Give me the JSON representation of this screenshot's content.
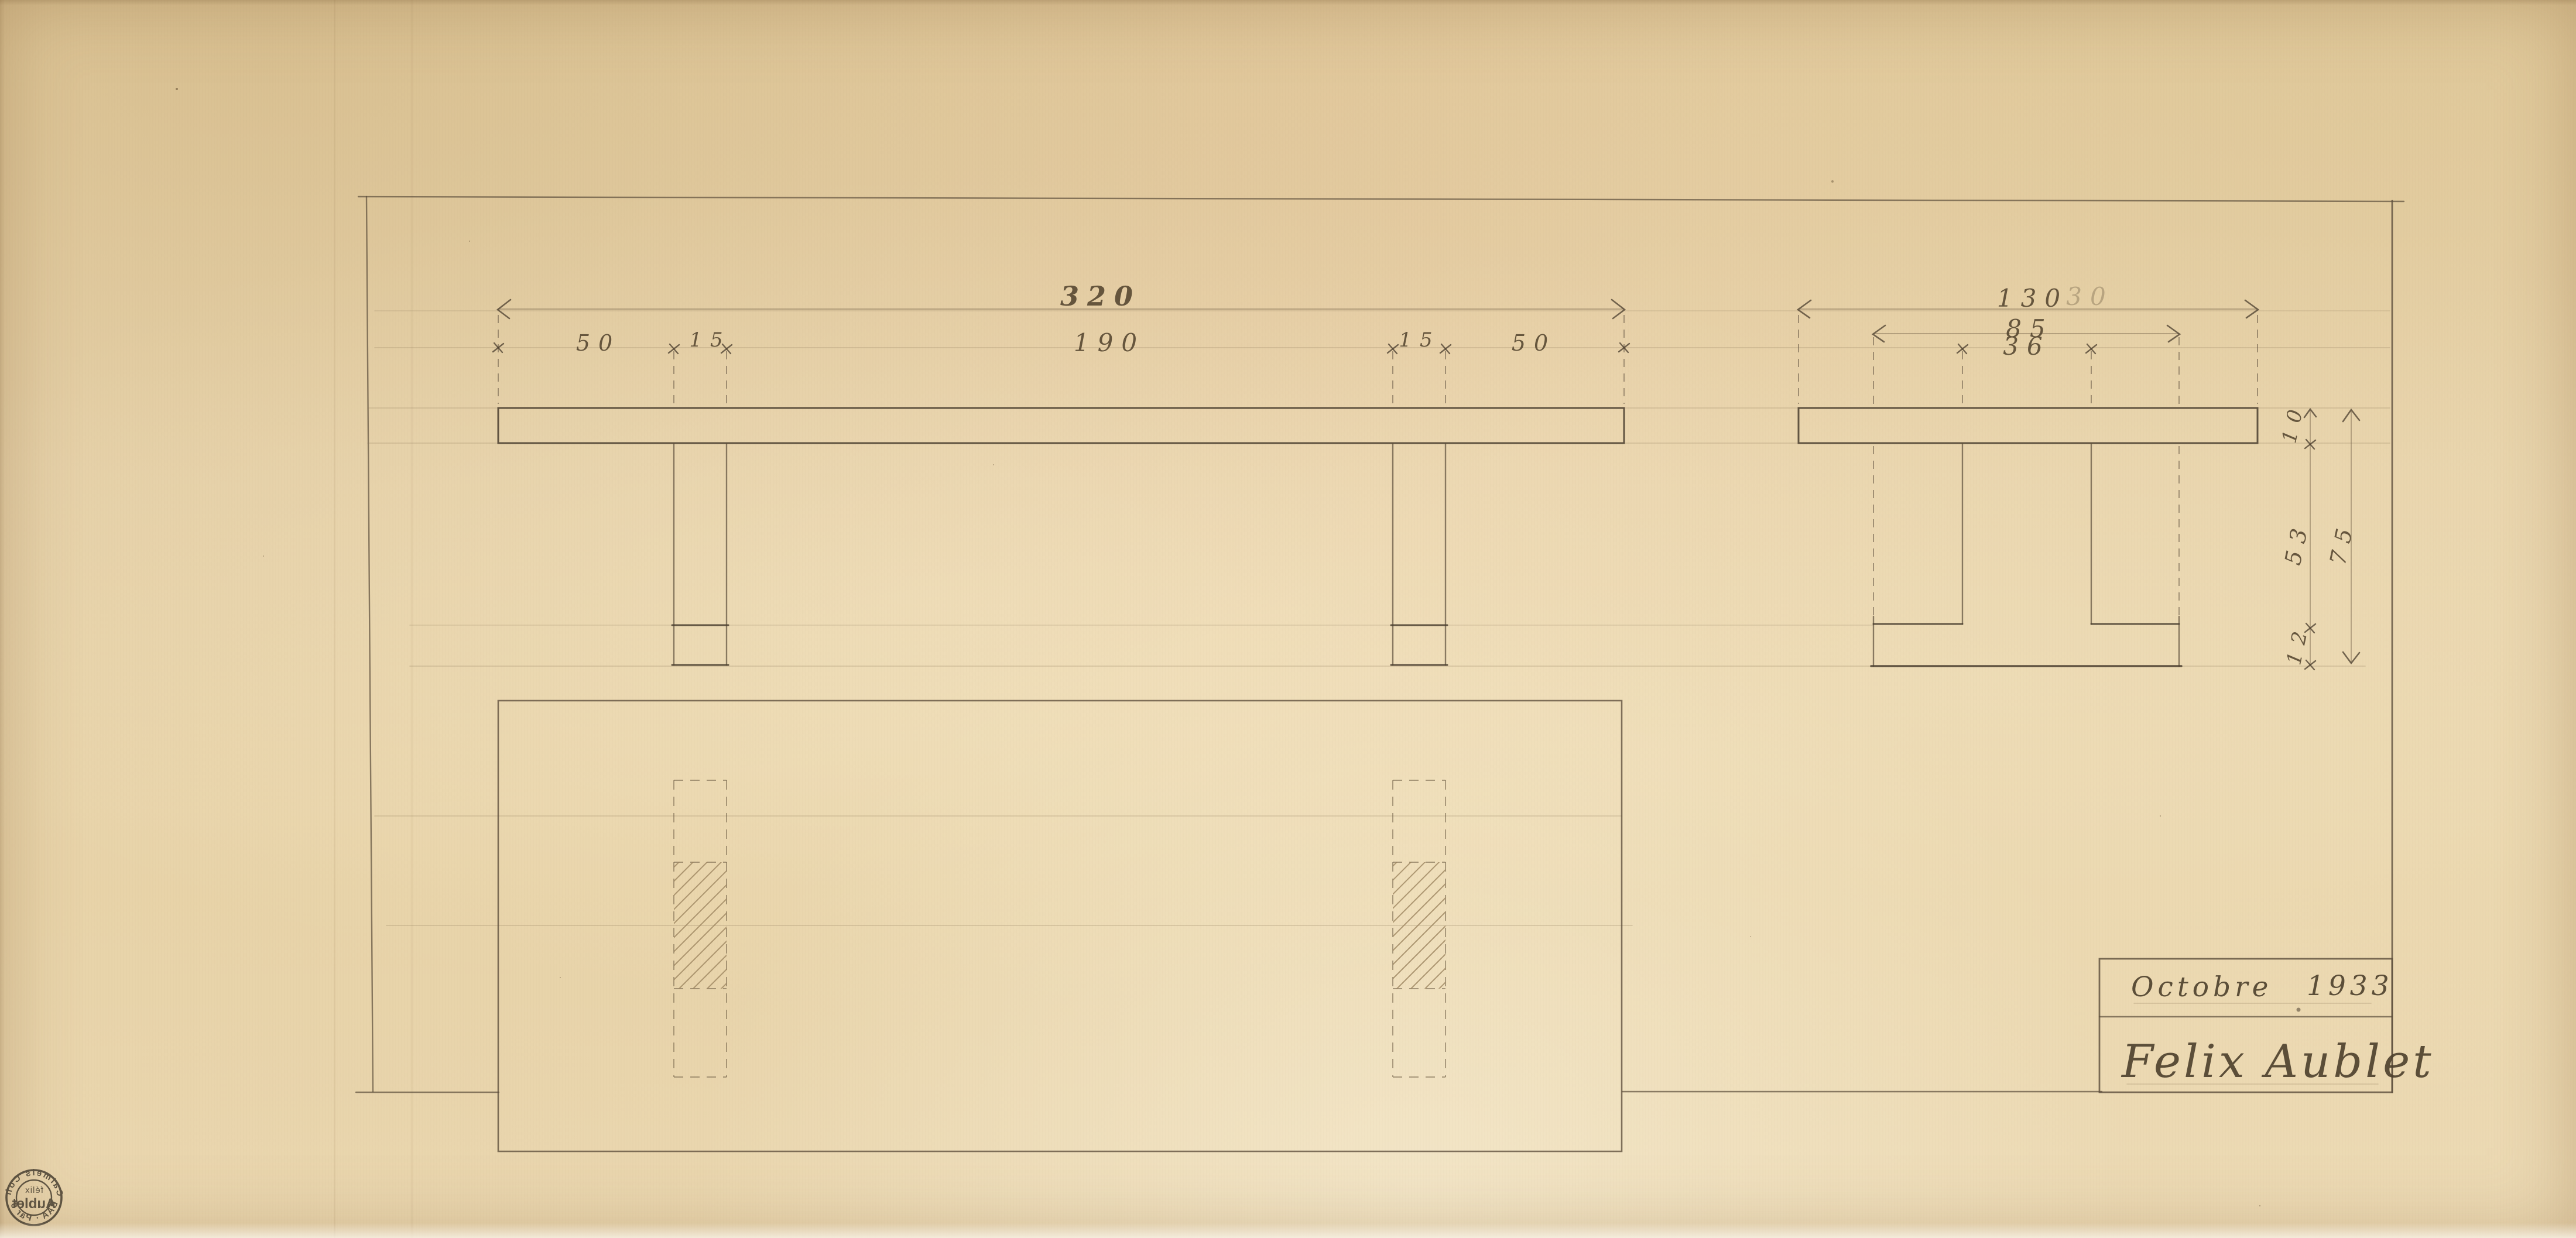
{
  "front_view": {
    "overall": "320",
    "span": "190",
    "overhang_left": "50",
    "leg_left": "15",
    "leg_right": "15",
    "overhang_right": "50"
  },
  "side_view": {
    "depth": "130",
    "depth_ghost": "30",
    "foot": "85",
    "leg": "36",
    "top_thickness": "10",
    "leg_height": "53",
    "foot_height": "12",
    "total_height": "75"
  },
  "title_block": {
    "month": "Octobre",
    "year": "1933",
    "signature": "Felix Aublet"
  },
  "stamp": {
    "ring_top": "Calmels Coh",
    "ring_bottom": "BAA · Par 9",
    "center_small": "félix",
    "center_large": "Aublet"
  }
}
